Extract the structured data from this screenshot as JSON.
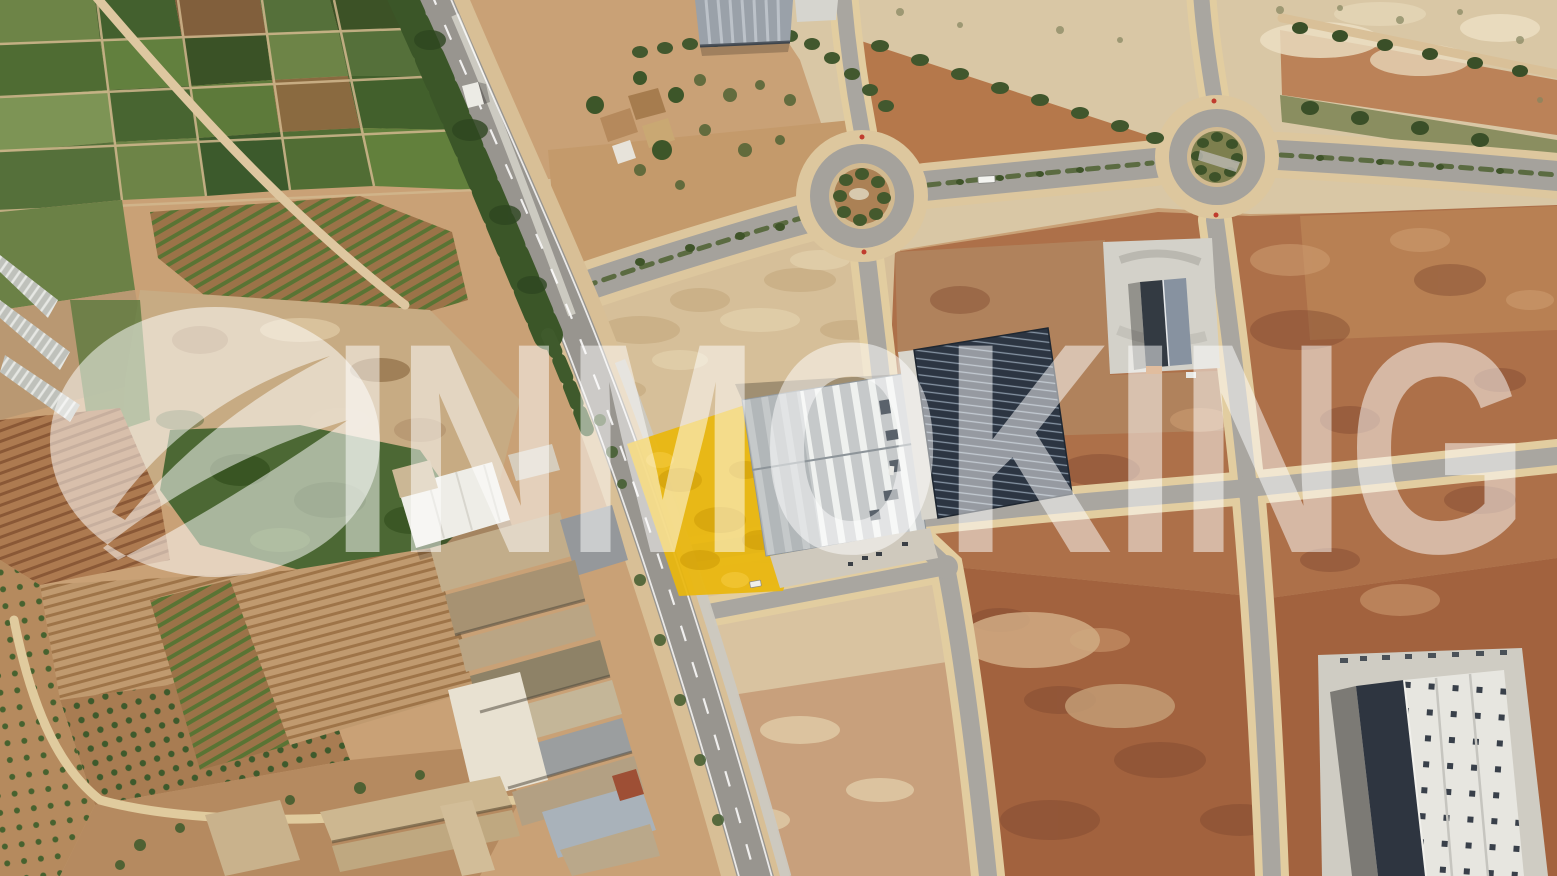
{
  "image": {
    "kind": "satellite-aerial-photograph",
    "watermark": {
      "brand": "INMOKING",
      "logo": "circle-leaf-emblem",
      "color": "#FFFFFF",
      "opacity": 0.5
    },
    "highlighted_parcel": {
      "fill": "#E9B70D",
      "shape": "quadrilateral"
    },
    "palette": {
      "farmland_green": "#55703A",
      "orchard_tree": "#3E5A2C",
      "dirt_red": "#AD7049",
      "sand_pale": "#D8C5A2",
      "road_asphalt": "#A8A5A0",
      "road_edge_sand": "#E2CDA0",
      "tree_strip": "#3B5628",
      "warehouse_roof": "#C6C9CA",
      "solar_roof": "#2C3542",
      "dark_roof": "#2E3540",
      "concrete": "#D0CEC6"
    },
    "features": [
      "agricultural-field-patchwork",
      "orchard-rows",
      "greenhouses",
      "main-diagonal-road",
      "roundabout-west",
      "roundabout-east",
      "street-grid",
      "highlighted-land-parcel",
      "industrial-warehouse",
      "solar-panel-roof-building",
      "concrete-pad-building",
      "farm-building-cluster",
      "large-industrial-building-southeast",
      "vacant-dirt-parcels"
    ]
  }
}
